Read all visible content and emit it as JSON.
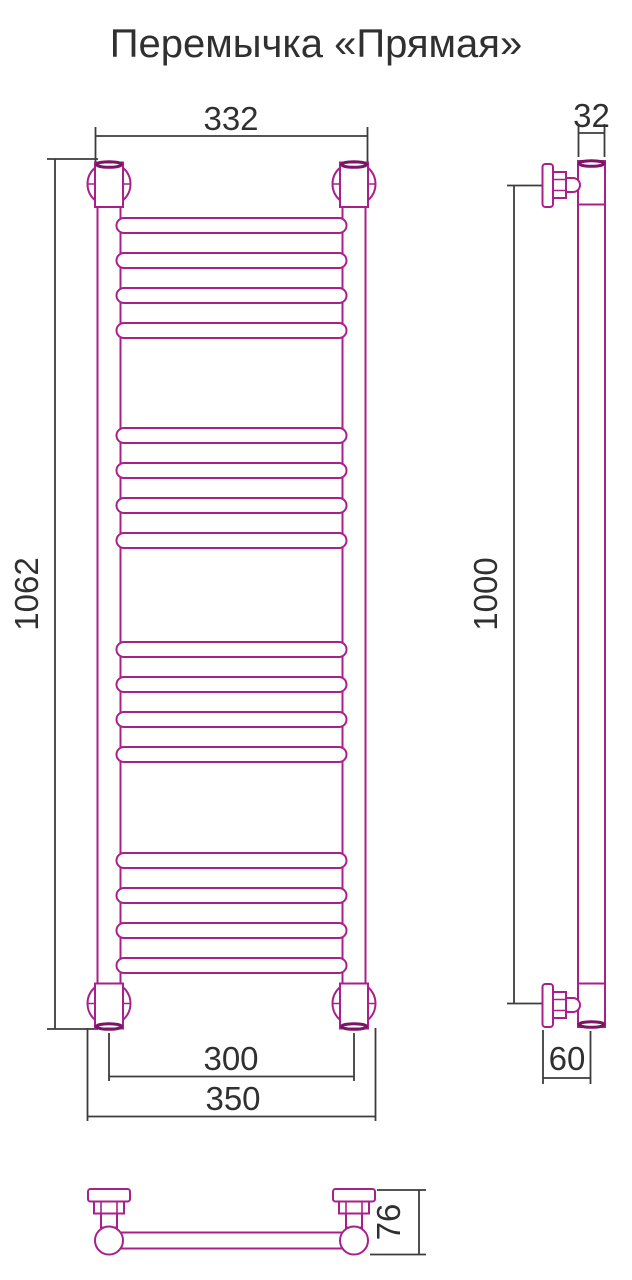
{
  "title": "Перемычка «Прямая»",
  "dimensions": {
    "top_width": "332",
    "overall_height": "1062",
    "inner_width": "300",
    "outer_width": "350",
    "tube_depth": "32",
    "mount_height": "1000",
    "wall_offset": "60",
    "bracket_depth": "76"
  },
  "colors": {
    "accent": "#A9208B",
    "accent-dark": "#7D1566",
    "line": "#3C3C3C",
    "ink": "#303030"
  }
}
